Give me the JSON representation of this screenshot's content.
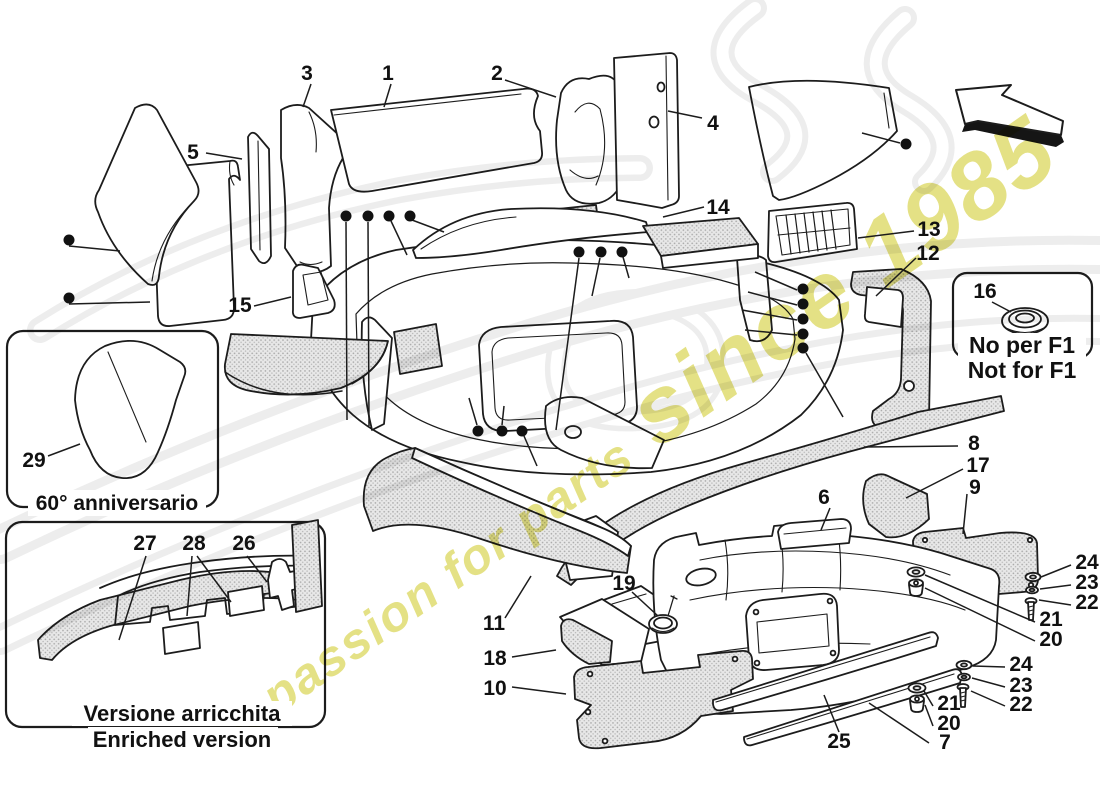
{
  "diagram": {
    "title": "Luggage compartment insulation – exploded parts diagram",
    "captions": {
      "anniversary": "60° anniversario",
      "enriched_it": "Versione arricchita",
      "enriched_en": "Enriched version",
      "f1_it": "No per F1",
      "f1_en": "Not for F1"
    },
    "watermark": {
      "tagline_lead": "a passion for parts",
      "tagline_year": "since 1985"
    },
    "colors": {
      "line": "#1c1c1c",
      "stipple_fill": "#e8e8e8",
      "stipple_dot": "#a9a9a9",
      "watermark_yellow": "#d4ce3a",
      "ghost_gray": "#ededed"
    },
    "part_numbers": {
      "n1": "1",
      "n2": "2",
      "n3": "3",
      "n4": "4",
      "n5": "5",
      "n6": "6",
      "n7": "7",
      "n8": "8",
      "n9": "9",
      "n10": "10",
      "n11": "11",
      "n12": "12",
      "n13": "13",
      "n14": "14",
      "n15": "15",
      "n16": "16",
      "n17": "17",
      "n18": "18",
      "n19": "19",
      "n20": "20",
      "n21": "21",
      "n22": "22",
      "n23": "23",
      "n24": "24",
      "n25": "25",
      "n26": "26",
      "n27": "27",
      "n28": "28",
      "n29": "29"
    }
  }
}
